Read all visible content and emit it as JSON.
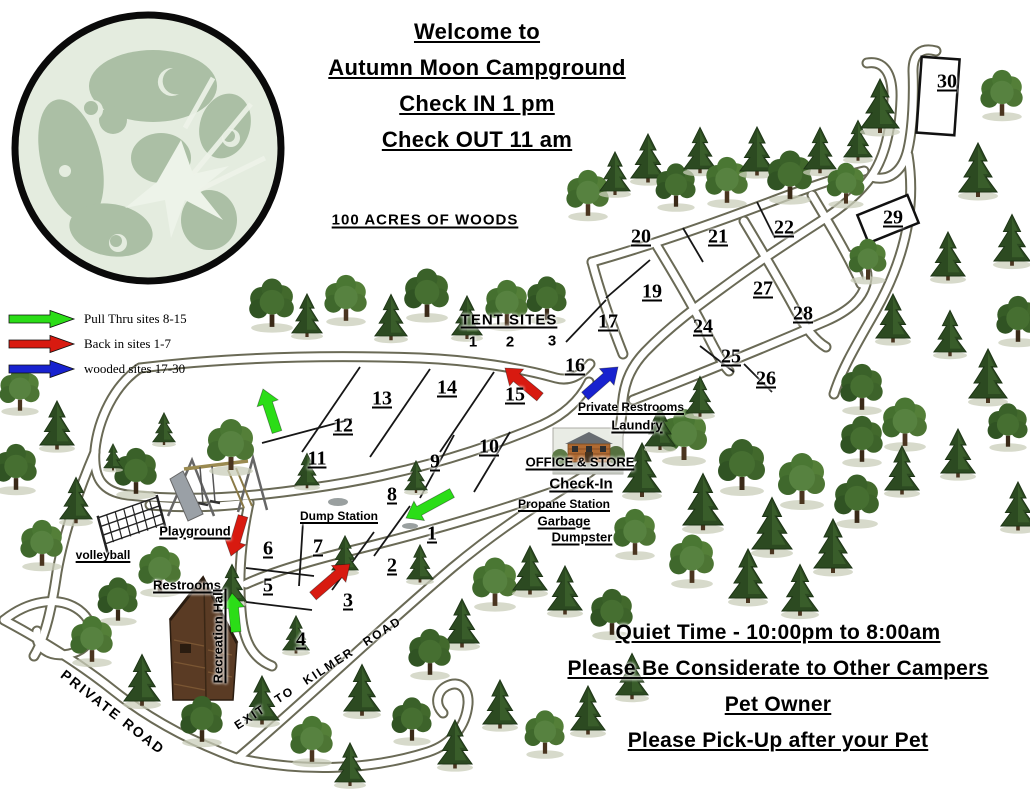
{
  "header": {
    "line1": "Welcome to",
    "line2": "Autumn Moon Campground",
    "line3": "Check IN 1 pm",
    "line4": "Check OUT 11 am"
  },
  "legend": {
    "items": [
      {
        "label": "Pull Thru sites 8-15",
        "color_key": "arrow_green"
      },
      {
        "label": "Back in sites 1-7",
        "color_key": "arrow_red"
      },
      {
        "label": "wooded sites 17-30",
        "color_key": "arrow_blue"
      }
    ]
  },
  "notices": {
    "woods": "100 ACRES OF WOODS",
    "quiet_time": "Quiet  Time - 10:00pm to 8:00am",
    "considerate": "Please Be Considerate to Other Campers",
    "pet_owner": "Pet Owner",
    "pet_pickup": "Please Pick-Up after your Pet"
  },
  "map": {
    "tent_sites": {
      "label": "TENT SITES",
      "numbers": [
        "1",
        "2",
        "3"
      ]
    },
    "sites": [
      {
        "n": "1",
        "x": 432,
        "y": 534
      },
      {
        "n": "2",
        "x": 392,
        "y": 566
      },
      {
        "n": "3",
        "x": 348,
        "y": 601
      },
      {
        "n": "4",
        "x": 301,
        "y": 640
      },
      {
        "n": "5",
        "x": 268,
        "y": 586
      },
      {
        "n": "6",
        "x": 268,
        "y": 549
      },
      {
        "n": "7",
        "x": 318,
        "y": 547
      },
      {
        "n": "8",
        "x": 392,
        "y": 495
      },
      {
        "n": "9",
        "x": 435,
        "y": 462
      },
      {
        "n": "10",
        "x": 489,
        "y": 447
      },
      {
        "n": "11",
        "x": 317,
        "y": 459
      },
      {
        "n": "12",
        "x": 343,
        "y": 426
      },
      {
        "n": "13",
        "x": 382,
        "y": 399
      },
      {
        "n": "14",
        "x": 447,
        "y": 388
      },
      {
        "n": "15",
        "x": 515,
        "y": 395
      },
      {
        "n": "16",
        "x": 575,
        "y": 366
      },
      {
        "n": "17",
        "x": 608,
        "y": 322
      },
      {
        "n": "19",
        "x": 652,
        "y": 292
      },
      {
        "n": "20",
        "x": 641,
        "y": 237
      },
      {
        "n": "21",
        "x": 718,
        "y": 237
      },
      {
        "n": "22",
        "x": 784,
        "y": 228
      },
      {
        "n": "24",
        "x": 703,
        "y": 327
      },
      {
        "n": "25",
        "x": 731,
        "y": 357
      },
      {
        "n": "26",
        "x": 766,
        "y": 379
      },
      {
        "n": "27",
        "x": 763,
        "y": 289
      },
      {
        "n": "28",
        "x": 803,
        "y": 314
      },
      {
        "n": "29",
        "x": 893,
        "y": 218
      },
      {
        "n": "30",
        "x": 947,
        "y": 82
      }
    ],
    "facilities": {
      "private_restrooms": "Private Restrooms",
      "laundry": "Laundry",
      "office_store": "OFFICE & STORE",
      "check_in": "Check-In",
      "propane_station": "Propane Station",
      "garbage": "Garbage",
      "dumpster": "Dumpster",
      "dump_station": "Dump Station",
      "playground": "Playground",
      "volleyball": "volleyball",
      "restrooms": "Restrooms",
      "recreation_hall": "Recreation  Hall"
    },
    "road_labels": {
      "private_road": "PRIVATE ROAD",
      "exit_kilmer": "EXIT TO KILMER ROAD"
    }
  },
  "colors": {
    "arrow_green": "#2bdd17",
    "arrow_red": "#d81a10",
    "arrow_blue": "#1822cf",
    "road_outline": "#6a6a56",
    "road_fill": "#ffffff",
    "moon_base": "#e4ecdf",
    "moon_blotch": "#abbfa5",
    "text": "#000000"
  }
}
